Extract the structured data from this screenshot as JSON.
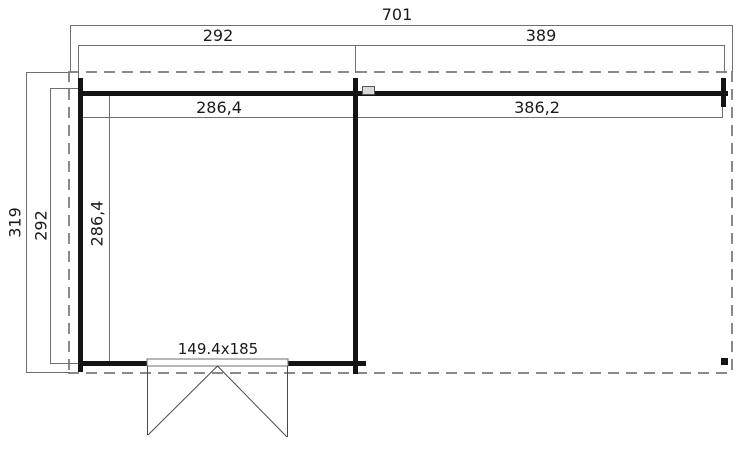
{
  "drawing": {
    "type": "floor-plan",
    "dims": {
      "total_width": "701",
      "section_left_width": "292",
      "section_right_width": "389",
      "interior_left_width": "286,4",
      "interior_right_width": "386,2",
      "total_depth": "319",
      "section_left_depth": "292",
      "interior_left_depth": "286,4",
      "door_size": "149.4x185"
    },
    "colors": {
      "wall": "#141414",
      "dimension_line": "#6f6f6f",
      "dashed_outline": "#8a8a8a",
      "text": "#1a1a1a",
      "background": "#ffffff"
    }
  }
}
